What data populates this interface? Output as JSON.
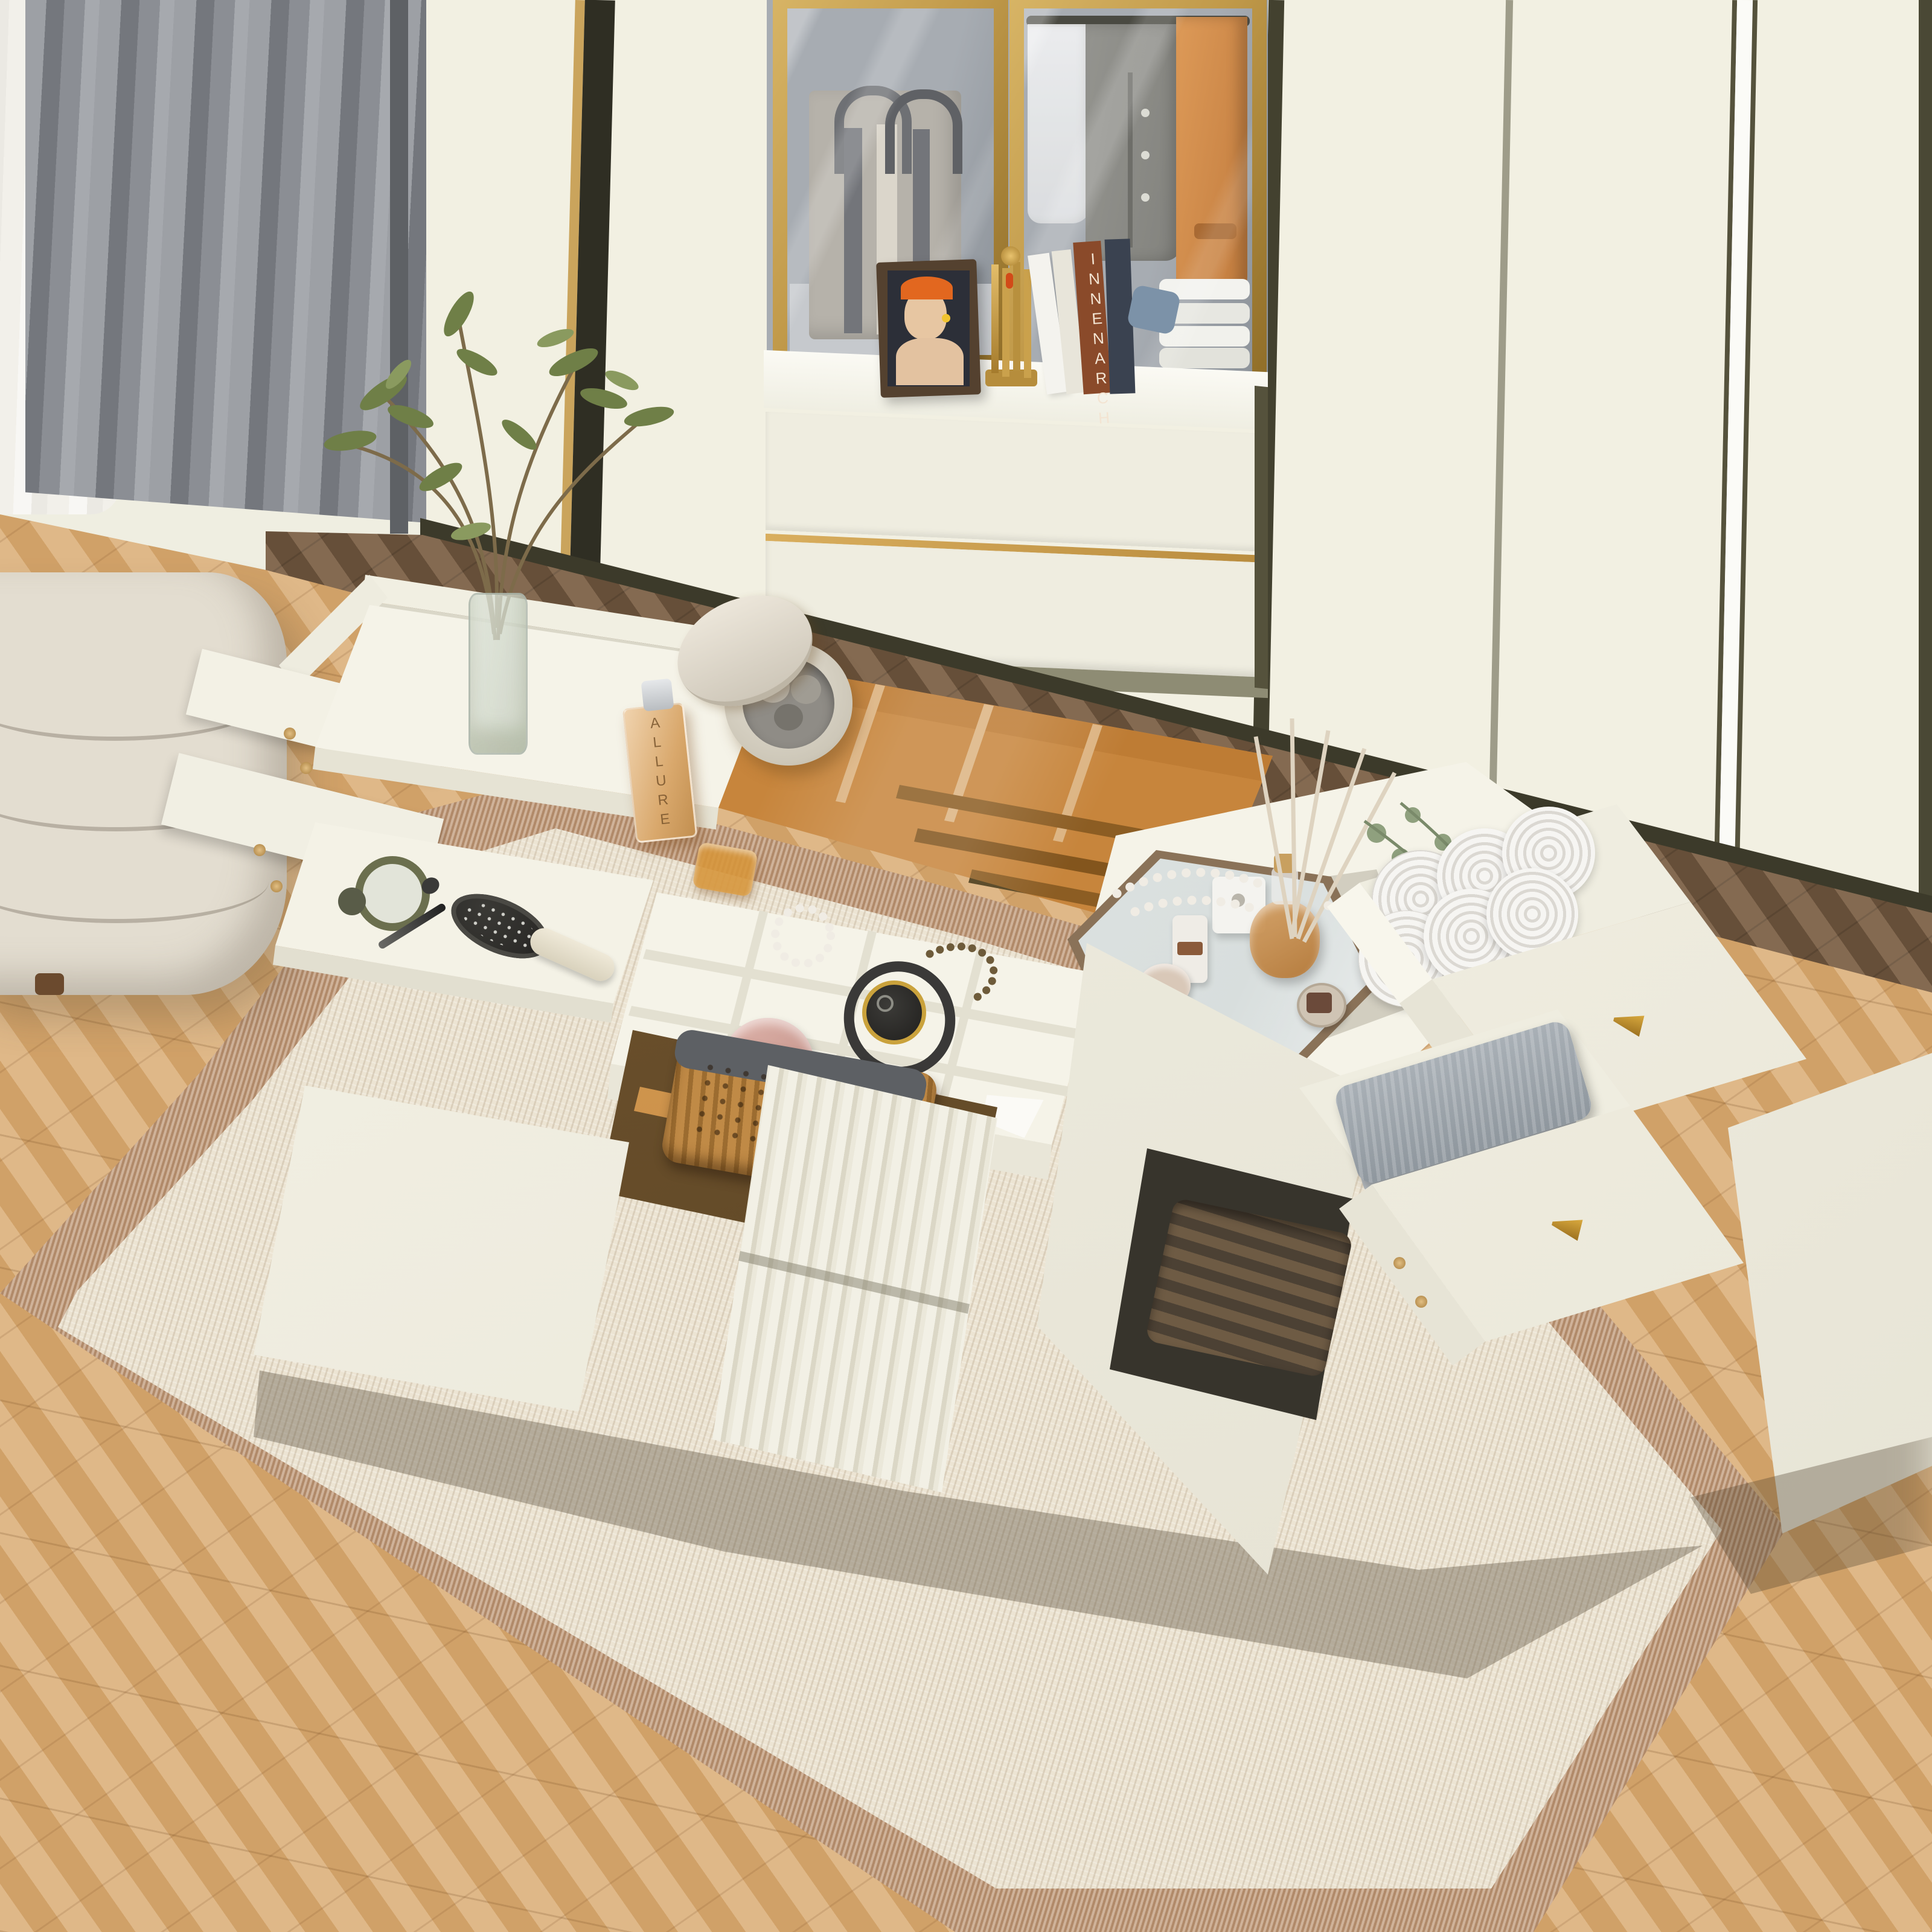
{
  "meta": {
    "title": "Bedroom scene with multifunctional white storage island vanity",
    "image_type": "furniture product render, top-down angled view"
  },
  "visible_text": {
    "perfume_label": "ALLURE",
    "book_spine": "INNENARCH",
    "compact_lid": "PONY EFFECT"
  },
  "palette": {
    "wall": "#efeee1",
    "panel": "#f2f0e2",
    "panel2": "#efede0",
    "trim": "#3c3a2a",
    "gold": "#c19a4a",
    "cabint": "#a7acb2",
    "floor": "#d9aa70",
    "platform": "#7b5f44",
    "rugborder": "#bf9877",
    "rugfield": "#ece4d3",
    "ottoman": "#e3ddd0",
    "island": "#f5f3e8",
    "tan": "#c8965a",
    "amberglass": "#c67019",
    "curtain": "#8b8e94",
    "graytowel": "#9ba3aa",
    "rattan": "#b5813f",
    "knobgold": "#b8892f"
  },
  "scene": {
    "wardrobe": {
      "style": "cream built-in wardrobe, dark olive trim seams, white LED strip",
      "display_cabinet": {
        "doors": "gold framed glass pair",
        "left_shelf_item": "gray striped tote bag with silver chain and star charm",
        "right_shelf_items": [
          "hanging white sheer blouse",
          "hanging gray jacket",
          "hanging orange coat",
          "stack of folded white knitwear"
        ],
        "counter_items": [
          "framed portrait photo of woman in orange hat",
          "gold art-deco sculpture",
          "leaning books",
          "blue cloth"
        ],
        "lower_drawers": 2
      }
    },
    "curtains": {
      "back": "white sheer",
      "front": "gray pleated floor-length"
    },
    "floor": {
      "front": "light oak herringbone",
      "platform": "dark walnut herringbone step"
    },
    "rug": {
      "field": "cream ribbed weave",
      "border": "tan woven band"
    },
    "ottoman": "cream channel-tufted bench with wood foot",
    "island": {
      "left_vanity": {
        "top_items": [
          "glass cylinder vase with green leafy branches"
        ],
        "open_side_drawers": 2
      },
      "center": {
        "amber_glass_top": true,
        "under_glass_items": [
          "ALLURE perfume bottle",
          "round stone trinket box with pebbles and open lid",
          "amber soap dish",
          "metal drawer slide rails",
          "white divider walls"
        ],
        "open_tray_items": [
          "olive hand mirror",
          "black makeup brush",
          "black paddle hair brush with cream handle"
        ],
        "jewelry_tray": {
          "grid": "3 rows x 4 columns",
          "items": [
            "gold chronograph watch with black strap",
            "rose-gold compact",
            "pearl bracelet",
            "dark bead bracelet",
            "lipstick",
            "white ring box"
          ]
        },
        "cabinet": {
          "shelf": "amber glass",
          "contents": [
            "rattan basket with gray liner"
          ],
          "doors": [
            "plain white door open",
            "fluted reeded doors open"
          ]
        }
      },
      "right_chest": {
        "top_items": [
          "hexagonal mirrored tray",
          "reed diffuser amber bottle",
          "white cube vase",
          "white perfume sprayer",
          "cream jar",
          "lidded jar",
          "pearl necklace",
          "white rose",
          "eucalyptus sprigs"
        ],
        "drawer_top": {
          "state": "open",
          "contents": "six rolled white towels",
          "knob": "gold cone"
        },
        "drawer_bottom": {
          "state": "open",
          "contents": "folded gray towels",
          "knob": "gold cone"
        },
        "far_drawer_panel": "fully pulled white drawer front over floor",
        "open_cubby": "dark woven basket"
      }
    }
  }
}
